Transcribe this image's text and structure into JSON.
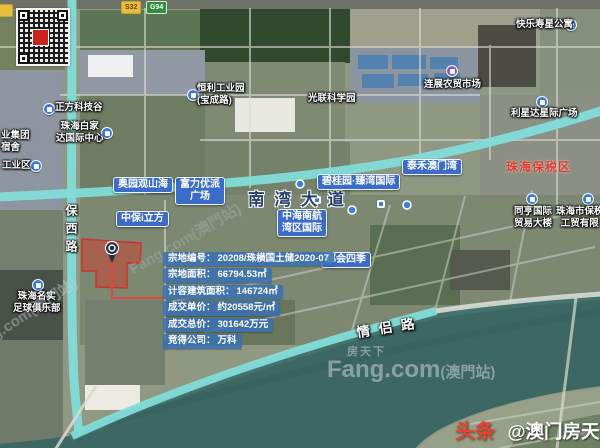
{
  "road_badges": {
    "b1": "S32",
    "b2": "G94"
  },
  "roads": {
    "baoxi": "保西路",
    "nanwan": "南湾大道",
    "qinglv": "情侣路"
  },
  "pills": {
    "aoyuan": "奥园观山海",
    "fuli_l1": "富力优派",
    "fuli_l2": "广场",
    "zhongbao": "中保i立方",
    "biguiyuan": "碧桂园·臻湾国际",
    "taihe": "泰禾澳门湾",
    "zhonghai_l1": "中海南航",
    "zhonghai_l2": "湾区国际",
    "duhui": "都会四季"
  },
  "pois": {
    "zhengfang": "正方科技谷",
    "baijia_l1": "珠海白家",
    "baijia_l2": "达国际中心",
    "hengli_l1": "恒利工业园",
    "hengli_l2": "(宝成路)",
    "guanglian": "光联科学园",
    "kuaile": "快乐寿星公寓",
    "lianzhan": "连展农贸市场",
    "lixingda": "利星达星际广场",
    "tongheng_l1": "同亨国际",
    "tongheng_l2": "贸易大楼",
    "gongmao_l1": "珠海市保税",
    "gongmao_l2": "工贸有限",
    "mingshi_l1": "珠海名实",
    "mingshi_l2": "足球俱乐部",
    "yejituan_l1": "业集团",
    "yejituan_l2": "宿舍",
    "gongyequ": "工业区",
    "baoshui": "珠海保税区"
  },
  "info_panel": {
    "rows": [
      {
        "label": "宗地编号：",
        "value": "20208/珠横国土储2020-07"
      },
      {
        "label": "宗地面积：",
        "value": "66794.53㎡"
      },
      {
        "label": "计容建筑面积：",
        "value": "146724㎡"
      },
      {
        "label": "成交单价：",
        "value": "约20558元/㎡"
      },
      {
        "label": "成交总价：",
        "value": "301642万元"
      },
      {
        "label": "竞得公司：",
        "value": "万科"
      }
    ]
  },
  "watermark": {
    "brand_cn": "房天下",
    "brand_en": "Fang.com",
    "site": "(澳門站)",
    "diag": "Fang.com(澳門站)"
  },
  "footer": {
    "brand": "头条",
    "account": "@澳门房天下"
  },
  "colors": {
    "pill_blue": "#3a6cc8",
    "panel_blue": "#3a70b4",
    "parcel_red": "#d03a2e",
    "route_cyan": "#82dcd8",
    "label_red": "#e23b2d"
  }
}
